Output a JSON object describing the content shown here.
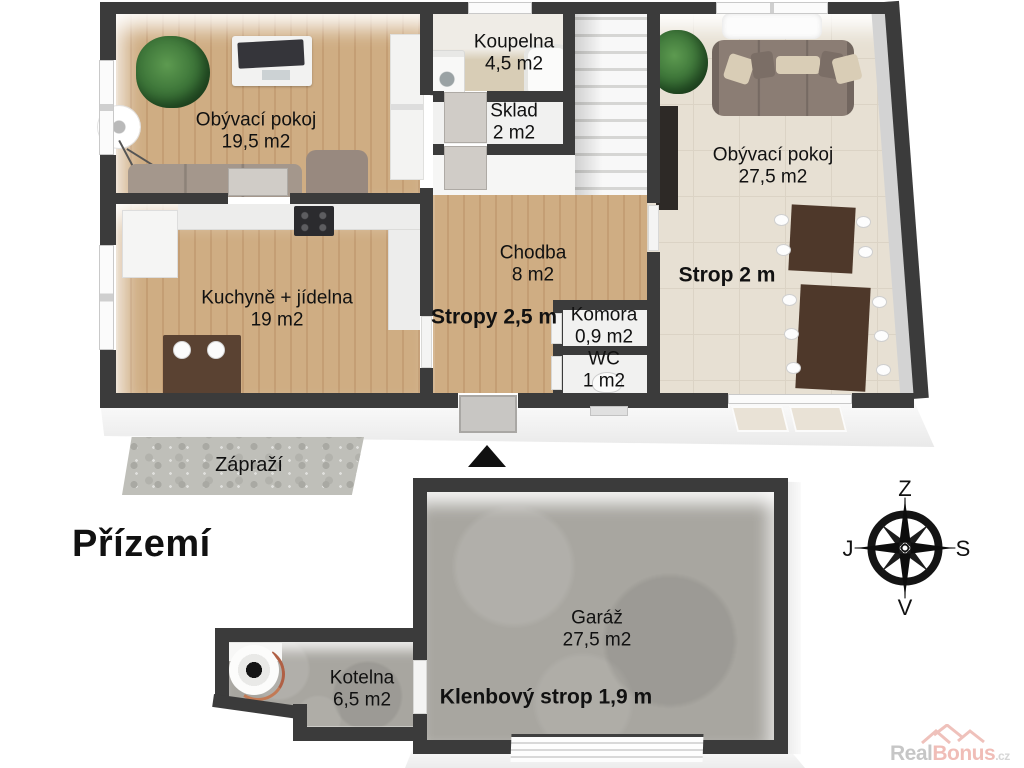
{
  "title": "Přízemí",
  "rooms": {
    "living1": {
      "name": "Obývací pokoj",
      "area": "19,5 m2"
    },
    "bathroom": {
      "name": "Koupelna",
      "area": "4,5 m2"
    },
    "storage": {
      "name": "Sklad",
      "area": "2 m2"
    },
    "living2": {
      "name": "Obývací pokoj",
      "area": "27,5 m2"
    },
    "kitchen": {
      "name": "Kuchyně + jídelna",
      "area": "19 m2"
    },
    "hallway": {
      "name": "Chodba",
      "area": "8 m2"
    },
    "pantry": {
      "name": "Komora",
      "area": "0,9 m2"
    },
    "wc": {
      "name": "WC",
      "area": "1 m2"
    },
    "garage": {
      "name": "Garáž",
      "area": "27,5 m2"
    },
    "boiler_room": {
      "name": "Kotelna",
      "area": "6,5 m2"
    }
  },
  "ceiling_notes": {
    "hallway": "Stropy 2,5 m",
    "living2": "Strop 2 m",
    "garage": "Klenbový strop 1,9 m"
  },
  "outdoor": {
    "porch": "Zápraží"
  },
  "compass": {
    "top": "Z",
    "left": "J",
    "right": "S",
    "bottom": "V"
  },
  "watermark": {
    "prefix": "Real",
    "suffix": "Bonus",
    "tld": ".cz"
  },
  "colors": {
    "wall": "#3b3b3b",
    "wood": "#cfad83",
    "wood-dark": "#c49e74",
    "tile": "#e7e0d3",
    "tile-line": "#dbd3c5",
    "bath-floor": "#d8cdb6",
    "white-floor": "#f1f1f0",
    "concrete": "#a8a6a0",
    "stone": "#bfbfb9",
    "door": "#d0ccc7",
    "watermark-pink": "#eeb2ab",
    "watermark-gray": "#bdbdbd"
  }
}
